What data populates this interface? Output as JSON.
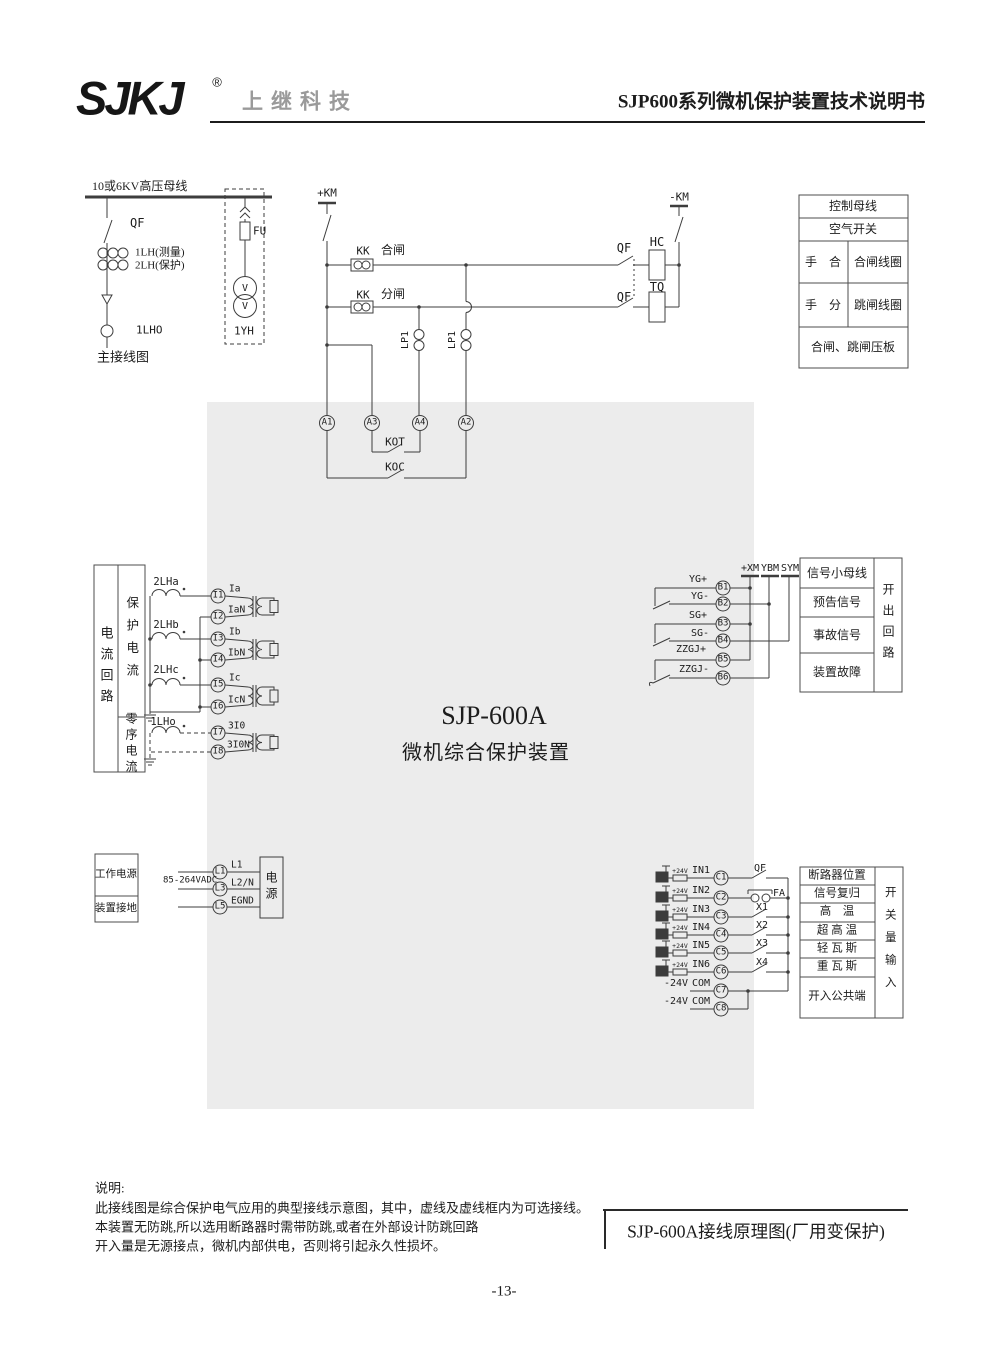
{
  "header": {
    "logo": "SJKJ",
    "reg": "®",
    "company": "上继科技",
    "doc_title": "SJP600系列微机保护装置技术说明书"
  },
  "primary": {
    "bus": "10或6KV高压母线",
    "qf": "QF",
    "ct_meas": "1LH(测量)",
    "ct_prot": "2LH(保护)",
    "ct_zero": "1LHO",
    "caption": "主接线图",
    "fuse": "FU",
    "vt": "1YH",
    "v1": "V",
    "v2": "V"
  },
  "control": {
    "km_pos": "+KM",
    "km_neg": "-KM",
    "kk1": "KK",
    "kk2": "KK",
    "close": "合闸",
    "trip": "分闸",
    "lp1a": "LP1",
    "lp1b": "LP1",
    "qf1": "QF",
    "qf2": "QF",
    "hc": "HC",
    "tq": "TQ",
    "kot": "KOT",
    "koc": "KOC",
    "a1": "A1",
    "a3": "A3",
    "a4": "A4",
    "a2": "A2"
  },
  "control_table": {
    "r1": "控制母线",
    "r2": "空气开关",
    "r3l": "手　合",
    "r3r": "合闸线圈",
    "r4l": "手　分",
    "r4r": "跳闸线圈",
    "r5": "合闸、跳闸压板"
  },
  "device": {
    "model": "SJP-600A",
    "name": "微机综合保护装置"
  },
  "current": {
    "group": "电流回路",
    "prot": "保护电流",
    "zero": "零序电流",
    "ct_a": "2LHa",
    "ct_b": "2LHb",
    "ct_c": "2LHc",
    "ct_o": "1LHo",
    "terms": [
      {
        "id": "I1",
        "sig": "Ia"
      },
      {
        "id": "I2",
        "sig": "IaN"
      },
      {
        "id": "I3",
        "sig": "Ib"
      },
      {
        "id": "I4",
        "sig": "IbN"
      },
      {
        "id": "I5",
        "sig": "Ic"
      },
      {
        "id": "I6",
        "sig": "IcN"
      },
      {
        "id": "I7",
        "sig": "3I0"
      },
      {
        "id": "I8",
        "sig": "3I0N"
      }
    ]
  },
  "signal": {
    "buses": [
      "+XM",
      "YBM",
      "SYM"
    ],
    "terms": [
      {
        "id": "B1",
        "sig": "YG+"
      },
      {
        "id": "B2",
        "sig": "YG-"
      },
      {
        "id": "B3",
        "sig": "SG+"
      },
      {
        "id": "B4",
        "sig": "SG-"
      },
      {
        "id": "B5",
        "sig": "ZZGJ+"
      },
      {
        "id": "B6",
        "sig": "ZZGJ-"
      }
    ],
    "table_rows": [
      "信号小母线",
      "预告信号",
      "事故信号",
      "装置故障"
    ],
    "table_col": "开出回路"
  },
  "power": {
    "row1": "工作电源",
    "row2": "装置接地",
    "voltage": "85-264VADC",
    "terms": [
      {
        "id": "L1",
        "sig": "L1"
      },
      {
        "id": "L3",
        "sig": "L2/N"
      },
      {
        "id": "L5",
        "sig": "EGND"
      }
    ],
    "box": "电源"
  },
  "inputs": {
    "r24": "+24V",
    "terms": [
      {
        "id": "C1",
        "sig": "IN1",
        "contact": "QF"
      },
      {
        "id": "C2",
        "sig": "IN2",
        "contact": "FA"
      },
      {
        "id": "C3",
        "sig": "IN3",
        "contact": "X1"
      },
      {
        "id": "C4",
        "sig": "IN4",
        "contact": "X2"
      },
      {
        "id": "C5",
        "sig": "IN5",
        "contact": "X3"
      },
      {
        "id": "C6",
        "sig": "IN6",
        "contact": "X4"
      },
      {
        "id": "C7",
        "neg": "-24V",
        "sig": "COM"
      },
      {
        "id": "C8",
        "neg": "-24V",
        "sig": "COM"
      }
    ],
    "table_rows": [
      "断路器位置",
      "信号复归",
      "高　温",
      "超 高 温",
      "轻 瓦 斯",
      "重 瓦 斯",
      "开入公共端"
    ],
    "table_col": "开关量输入"
  },
  "notes": {
    "title": "说明:",
    "line1": "此接线图是综合保护电气应用的典型接线示意图，其中，虚线及虚线框内为可选接线。",
    "line2": "本装置无防跳,所以选用断路器时需带防跳,或者在外部设计防跳回路",
    "line3": "开入量是无源接点，微机内部供电，否则将引起永久性损坏。"
  },
  "title_block": "SJP-600A接线原理图(厂用变保护)",
  "page_number": "-13-"
}
